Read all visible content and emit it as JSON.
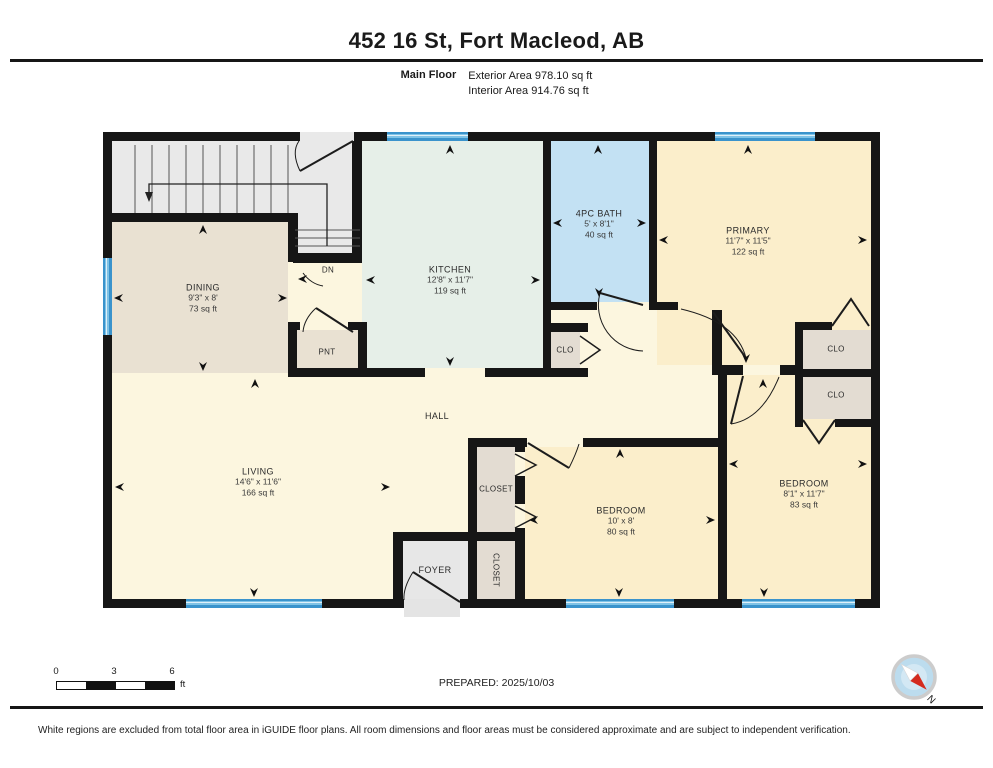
{
  "header": {
    "title": "452 16 St, Fort Macleod, AB",
    "floor_label": "Main Floor",
    "exterior_area": "Exterior Area 978.10 sq ft",
    "interior_area": "Interior Area 914.76 sq ft"
  },
  "rooms": {
    "dining": {
      "name": "DINING",
      "dims": "9'3\" x 8'",
      "area": "73 sq ft"
    },
    "kitchen": {
      "name": "KITCHEN",
      "dims": "12'8\" x 11'7\"",
      "area": "119 sq ft"
    },
    "bath": {
      "name": "4PC BATH",
      "dims": "5' x 8'1\"",
      "area": "40 sq ft"
    },
    "primary": {
      "name": "PRIMARY",
      "dims": "11'7\" x 11'5\"",
      "area": "122 sq ft"
    },
    "living": {
      "name": "LIVING",
      "dims": "14'6\" x 11'6\"",
      "area": "166 sq ft"
    },
    "hall": {
      "name": "HALL"
    },
    "bedroom1": {
      "name": "BEDROOM",
      "dims": "10' x 8'",
      "area": "80 sq ft"
    },
    "bedroom2": {
      "name": "BEDROOM",
      "dims": "8'1\" x 11'7\"",
      "area": "83 sq ft"
    },
    "foyer": {
      "name": "FOYER"
    },
    "pantry": {
      "name": "PNT"
    },
    "closet_hall": {
      "name": "CLOSET"
    },
    "closet_foyer": {
      "name": "CLOSET"
    },
    "clo_bath": {
      "name": "CLO"
    },
    "clo_primary": {
      "name": "CLO"
    },
    "clo_bedroom2": {
      "name": "CLO"
    },
    "stairs": {
      "down_label": "DN"
    }
  },
  "scale_bar": {
    "tick_0": "0",
    "tick_3": "3",
    "tick_6": "6",
    "unit": "ft"
  },
  "compass": {
    "north_label": "N"
  },
  "footer": {
    "prepared": "PREPARED: 2025/10/03",
    "disclaimer": "White regions are excluded from total floor area in iGUIDE floor plans. All room dimensions and floor areas must be considered approximate and are subject to independent verification."
  },
  "colors": {
    "wall": "#161616",
    "window": "#3a93cc",
    "hall": "#fcf6df",
    "bedroom": "#fbeecb",
    "dining": "#e9e1d2",
    "kitchen": "#e6efe8",
    "bath": "#c3e1f3",
    "stairs": "#e9e9e9",
    "closet": "#e3dcd2",
    "foyer": "#e7e7e7",
    "compass_red": "#d42b1e"
  }
}
